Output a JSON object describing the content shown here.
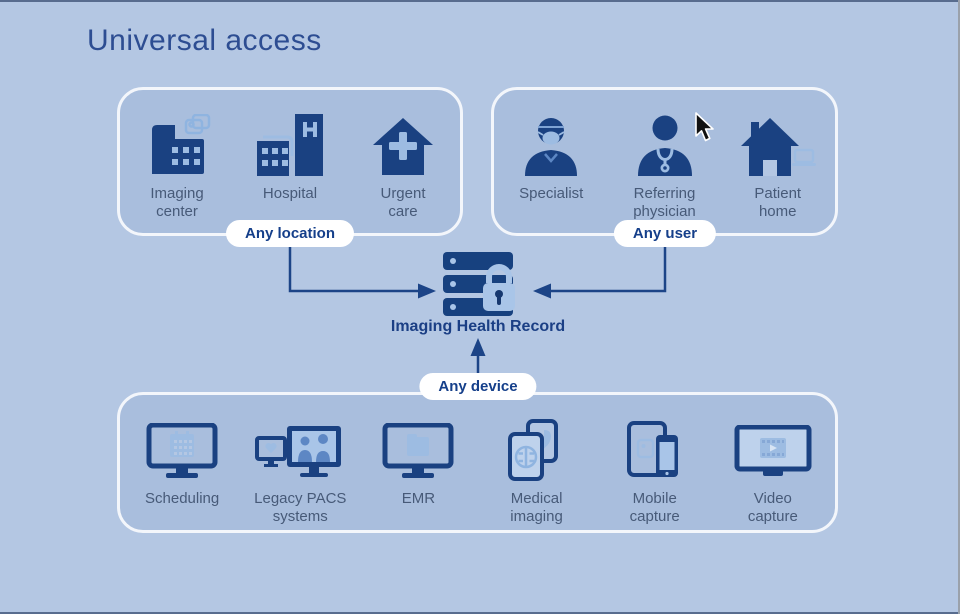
{
  "title": "Universal access",
  "center": {
    "label": "Imaging Health Record",
    "icon": "server-lock-icon"
  },
  "pills": {
    "location": "Any location",
    "user": "Any user",
    "device": "Any device"
  },
  "groups": {
    "location": {
      "items": [
        {
          "label": "Imaging\ncenter",
          "icon": "imaging-center-icon"
        },
        {
          "label": "Hospital",
          "icon": "hospital-icon"
        },
        {
          "label": "Urgent\ncare",
          "icon": "urgent-care-icon"
        }
      ]
    },
    "user": {
      "items": [
        {
          "label": "Specialist",
          "icon": "specialist-icon"
        },
        {
          "label": "Referring\nphysician",
          "icon": "referring-physician-icon"
        },
        {
          "label": "Patient\nhome",
          "icon": "patient-home-icon"
        }
      ]
    },
    "device": {
      "items": [
        {
          "label": "Scheduling",
          "icon": "scheduling-icon"
        },
        {
          "label": "Legacy PACS\nsystems",
          "icon": "legacy-pacs-icon"
        },
        {
          "label": "EMR",
          "icon": "emr-icon"
        },
        {
          "label": "Medical\nimaging",
          "icon": "medical-imaging-icon"
        },
        {
          "label": "Mobile\ncapture",
          "icon": "mobile-capture-icon"
        },
        {
          "label": "Video\ncapture",
          "icon": "video-capture-icon"
        }
      ]
    }
  },
  "cursor": {
    "icon": "mouse-pointer-icon"
  },
  "colors": {
    "background": "#b4c7e3",
    "icon_navy": "#1a4181",
    "icon_light": "#9dbce2",
    "screen_fill": "#bed2ec",
    "avatar_mid": "#5d87c4",
    "title_text": "#2d4d92",
    "label_text": "#475a78",
    "pill_bg": "#ffffff",
    "pill_text": "#153f8a",
    "line": "#1c4487",
    "box_border": "#f3f6fb"
  }
}
